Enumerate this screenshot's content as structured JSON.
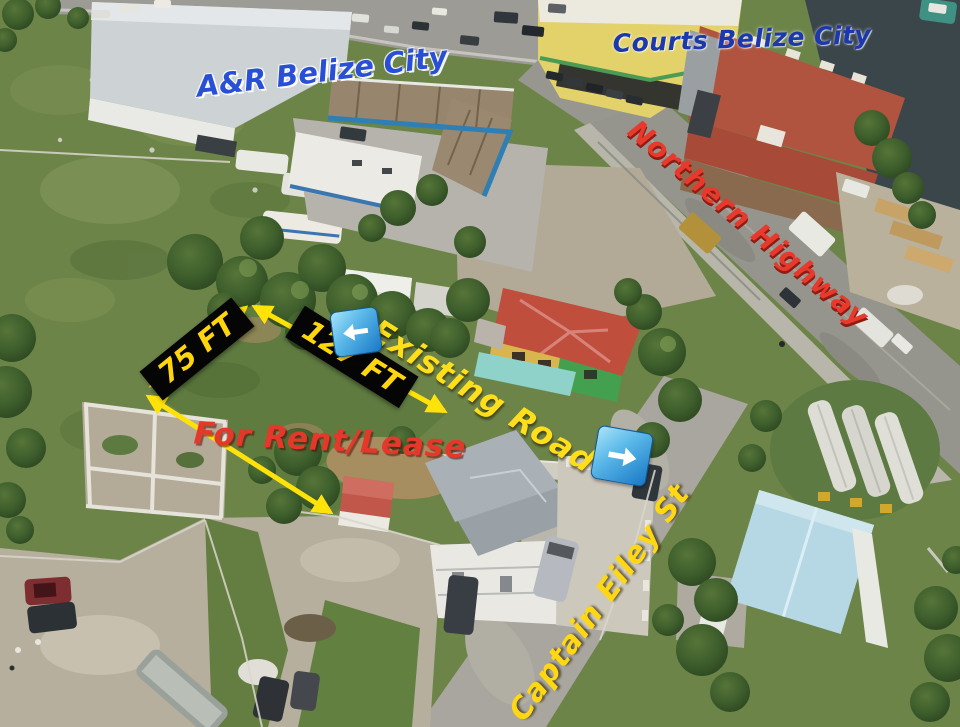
{
  "annotations": {
    "labels": {
      "courts": {
        "text": "Courts Belize City",
        "color": "#1c38ad"
      },
      "ar": {
        "text": "A&R Belize City",
        "color": "#2a4fd7"
      },
      "northern_highway": {
        "text": "Northern Highway",
        "color": "#e8392c"
      },
      "existing_road": {
        "text": "Existing Road",
        "color": "#ffdf1b"
      },
      "for_rent_lease": {
        "text": "For Rent/Lease",
        "color": "#e6382a"
      },
      "captain_eiley_st": {
        "text": "Captain Eiley St",
        "color": "#ffd813"
      }
    },
    "measurements": {
      "width": {
        "text": "75 FT",
        "text_color": "#ffd60e",
        "box_color": "#050505"
      },
      "length": {
        "text": "127 FT",
        "text_color": "#ffd60e",
        "box_color": "#050505"
      },
      "line_color": "#ffe20a"
    },
    "markers": {
      "left_arrow_icon": "left-direction-arrow",
      "right_arrow_icon": "right-direction-arrow",
      "icon_gradient_top": "#a8e4f8",
      "icon_gradient_bottom": "#1878c6"
    }
  }
}
